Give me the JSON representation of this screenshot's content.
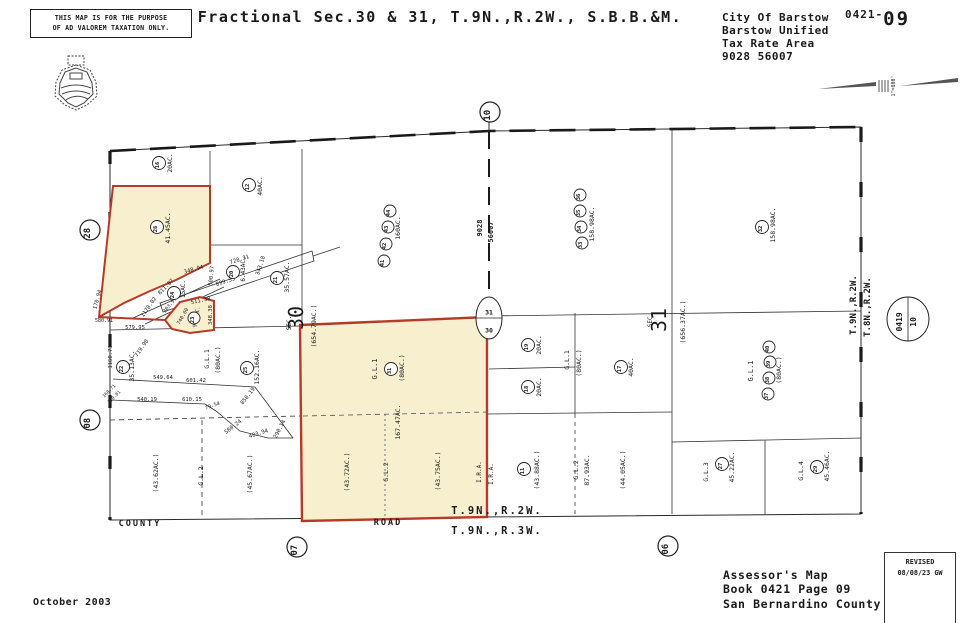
{
  "header": {
    "disclaimer_line1": "THIS MAP IS FOR THE PURPOSE",
    "disclaimer_line2": "OF AD VALOREM TAXATION ONLY.",
    "title": "Fractional Sec.30 & 31, T.9N.,R.2W., S.B.B.&M.",
    "agency_lines": [
      "City Of Barstow",
      "Barstow Unified",
      "Tax Rate Area",
      "9028 56007"
    ],
    "page_ref_prefix": "0421-",
    "page_ref_number": "09",
    "scale_label": "1\"=800'"
  },
  "footer": {
    "date": "October 2003",
    "assessor_lines": [
      "Assessor's Map",
      "Book 0421 Page 09",
      "San Bernardino County"
    ],
    "revised_title": "REVISED",
    "revised_note": "08/08/23 GW"
  },
  "colors": {
    "parcel_fill": "#f7efce",
    "parcel_stroke": "#b63a28",
    "line": "#2a2a2a"
  },
  "map": {
    "texts": [
      {
        "t": "20AC.",
        "x": 172,
        "y": 163,
        "r": -90,
        "s": 6.5
      },
      {
        "t": "40AC.",
        "x": 262,
        "y": 186,
        "r": -90,
        "s": 6.5
      },
      {
        "t": "41.45AC.",
        "x": 170,
        "y": 228,
        "r": -90,
        "s": 6.5
      },
      {
        "t": "15AC.",
        "x": 185,
        "y": 289,
        "r": -90,
        "s": 6
      },
      {
        "t": "6.43AC.",
        "x": 245,
        "y": 269,
        "r": -90,
        "s": 6
      },
      {
        "t": "35.57AC.",
        "x": 289,
        "y": 277,
        "r": -90,
        "s": 6.5
      },
      {
        "t": "160AC.",
        "x": 400,
        "y": 228,
        "r": -90,
        "s": 6.5
      },
      {
        "t": "9028",
        "x": 482,
        "y": 228,
        "r": -90,
        "s": 7,
        "b": true
      },
      {
        "t": "56007",
        "x": 493,
        "y": 232,
        "r": -90,
        "s": 7,
        "b": true
      },
      {
        "t": "158.98AC.",
        "x": 594,
        "y": 224,
        "r": -90,
        "s": 6.5
      },
      {
        "t": "158.98AC.",
        "x": 775,
        "y": 225,
        "r": -90,
        "s": 6.5
      },
      {
        "t": "SEC.",
        "x": 291,
        "y": 323,
        "r": -90,
        "s": 6
      },
      {
        "t": "30",
        "x": 303,
        "y": 318,
        "r": -90,
        "s": 20
      },
      {
        "t": "(654.79AC.)",
        "x": 316,
        "y": 326,
        "r": -90,
        "s": 6.5
      },
      {
        "t": "SEC.",
        "x": 652,
        "y": 320,
        "r": -90,
        "s": 6
      },
      {
        "t": "31",
        "x": 666,
        "y": 320,
        "r": -90,
        "s": 20
      },
      {
        "t": "(656.37AC.)",
        "x": 685,
        "y": 322,
        "r": -90,
        "s": 6.5
      },
      {
        "t": "T.9N.,R.2W.",
        "x": 856,
        "y": 305,
        "r": -90,
        "s": 9,
        "b": true
      },
      {
        "t": "T.8N.,R.2W.",
        "x": 870,
        "y": 307,
        "r": -90,
        "s": 9,
        "b": true
      },
      {
        "t": "728.31",
        "x": 240,
        "y": 261,
        "r": -18,
        "s": 5.5
      },
      {
        "t": "343.18",
        "x": 262,
        "y": 266,
        "r": -72,
        "s": 5.5
      },
      {
        "t": "899.35",
        "x": 226,
        "y": 283,
        "r": -18,
        "s": 5.5
      },
      {
        "t": "500.97",
        "x": 213,
        "y": 276,
        "r": -85,
        "s": 5.5
      },
      {
        "t": "348.94",
        "x": 194,
        "y": 271,
        "r": -15,
        "s": 5.5
      },
      {
        "t": "811.87",
        "x": 167,
        "y": 288,
        "r": -45,
        "s": 5.5
      },
      {
        "t": "1178.02",
        "x": 150,
        "y": 308,
        "r": -55,
        "s": 5.5
      },
      {
        "t": "303.57",
        "x": 171,
        "y": 306,
        "r": -50,
        "s": 5
      },
      {
        "t": "170.94",
        "x": 99,
        "y": 300,
        "r": -75,
        "s": 5.5
      },
      {
        "t": "580.91",
        "x": 104,
        "y": 322,
        "r": 0,
        "s": 5
      },
      {
        "t": "579.95",
        "x": 135,
        "y": 329,
        "r": 0,
        "s": 5.5
      },
      {
        "t": "511.38",
        "x": 201,
        "y": 302,
        "r": -12,
        "s": 5.5
      },
      {
        "t": "348.38",
        "x": 212,
        "y": 315,
        "r": -90,
        "s": 5.5
      },
      {
        "t": "740.60",
        "x": 184,
        "y": 317,
        "r": -60,
        "s": 5
      },
      {
        "t": "9.34AC.",
        "x": 198,
        "y": 317,
        "r": -80,
        "s": 5
      },
      {
        "t": "719.98",
        "x": 143,
        "y": 349,
        "r": -55,
        "s": 5.5
      },
      {
        "t": "1160.73",
        "x": 112,
        "y": 357,
        "r": -90,
        "s": 5.5
      },
      {
        "t": "35.13AC.",
        "x": 134,
        "y": 366,
        "r": -90,
        "s": 6.5
      },
      {
        "t": "549.64",
        "x": 163,
        "y": 379,
        "r": 0,
        "s": 5.5
      },
      {
        "t": "601.42",
        "x": 196,
        "y": 382,
        "r": 0,
        "s": 5.5
      },
      {
        "t": "850.19",
        "x": 249,
        "y": 397,
        "r": -52,
        "s": 5.5
      },
      {
        "t": "540.19",
        "x": 147,
        "y": 401,
        "r": 0,
        "s": 5.5
      },
      {
        "t": "610.15",
        "x": 192,
        "y": 401,
        "r": 0,
        "s": 5.5
      },
      {
        "t": "79.54",
        "x": 213,
        "y": 407,
        "r": -20,
        "s": 5
      },
      {
        "t": "160.71",
        "x": 110,
        "y": 392,
        "r": -45,
        "s": 4.5
      },
      {
        "t": "110.01",
        "x": 115,
        "y": 398,
        "r": -45,
        "s": 4.5
      },
      {
        "t": "580.24",
        "x": 234,
        "y": 428,
        "r": -38,
        "s": 5.5
      },
      {
        "t": "483.94",
        "x": 259,
        "y": 435,
        "r": -18,
        "s": 5.5
      },
      {
        "t": "290.14",
        "x": 281,
        "y": 430,
        "r": -62,
        "s": 5.5
      },
      {
        "t": "G.L.1",
        "x": 209,
        "y": 359,
        "r": -90,
        "s": 6.5
      },
      {
        "t": "(80AC.)",
        "x": 220,
        "y": 360,
        "r": -90,
        "s": 6.5
      },
      {
        "t": "152.16AC.",
        "x": 259,
        "y": 367,
        "r": -90,
        "s": 6.5
      },
      {
        "t": "G.L.1",
        "x": 377,
        "y": 369,
        "r": -90,
        "s": 7
      },
      {
        "t": "(80AC.)",
        "x": 404,
        "y": 368,
        "r": -90,
        "s": 6.5
      },
      {
        "t": "167.47AC.",
        "x": 400,
        "y": 422,
        "r": -90,
        "s": 6.5
      },
      {
        "t": "(43.72AC.)",
        "x": 349,
        "y": 472,
        "r": -90,
        "s": 6.5
      },
      {
        "t": "G.L.2",
        "x": 388,
        "y": 472,
        "r": -90,
        "s": 6.5
      },
      {
        "t": "(43.75AC.)",
        "x": 440,
        "y": 471,
        "r": -90,
        "s": 6.5
      },
      {
        "t": "I.R.A.",
        "x": 481,
        "y": 472,
        "r": -90,
        "s": 6
      },
      {
        "t": "I.R.A.",
        "x": 493,
        "y": 474,
        "r": -90,
        "s": 6
      },
      {
        "t": "20AC.",
        "x": 541,
        "y": 345,
        "r": -90,
        "s": 6.5
      },
      {
        "t": "20AC.",
        "x": 541,
        "y": 387,
        "r": -90,
        "s": 6.5
      },
      {
        "t": "G.L.1",
        "x": 569,
        "y": 360,
        "r": -90,
        "s": 6.5
      },
      {
        "t": "(80AC.)",
        "x": 581,
        "y": 363,
        "r": -90,
        "s": 6.5
      },
      {
        "t": "40AC.",
        "x": 633,
        "y": 367,
        "r": -90,
        "s": 6.5
      },
      {
        "t": "G.L.1",
        "x": 753,
        "y": 371,
        "r": -90,
        "s": 7
      },
      {
        "t": "(80AC.)",
        "x": 781,
        "y": 370,
        "r": -90,
        "s": 6.5
      },
      {
        "t": "(43.62AC.)",
        "x": 158,
        "y": 473,
        "r": -90,
        "s": 6.5
      },
      {
        "t": "G.L.2",
        "x": 203,
        "y": 476,
        "r": -90,
        "s": 6.5
      },
      {
        "t": "(45.67AC.)",
        "x": 252,
        "y": 474,
        "r": -90,
        "s": 6.5
      },
      {
        "t": "(43.88AC.)",
        "x": 539,
        "y": 470,
        "r": -90,
        "s": 6.5
      },
      {
        "t": "G.L.2",
        "x": 578,
        "y": 470,
        "r": -90,
        "s": 6.5
      },
      {
        "t": "87.93AC.",
        "x": 589,
        "y": 470,
        "r": -90,
        "s": 6.5
      },
      {
        "t": "(44.05AC.)",
        "x": 625,
        "y": 470,
        "r": -90,
        "s": 6.5
      },
      {
        "t": "G.L.3",
        "x": 708,
        "y": 472,
        "r": -90,
        "s": 6.5
      },
      {
        "t": "45.22AC.",
        "x": 734,
        "y": 467,
        "r": -90,
        "s": 6.5
      },
      {
        "t": "G.L.4",
        "x": 803,
        "y": 471,
        "r": -90,
        "s": 6.5
      },
      {
        "t": "45.46AC.",
        "x": 829,
        "y": 466,
        "r": -90,
        "s": 6.5
      },
      {
        "t": "COUNTY",
        "x": 140,
        "y": 526,
        "r": 0,
        "s": 8.5,
        "b": true,
        "ls": 2
      },
      {
        "t": "ROAD",
        "x": 388,
        "y": 525,
        "r": 0,
        "s": 8.5,
        "b": true,
        "ls": 2,
        "c": "#b63a28"
      },
      {
        "t": "T.9N.,R.2W.",
        "x": 497,
        "y": 514,
        "r": 0,
        "s": 10.5,
        "b": true,
        "ls": 2
      },
      {
        "t": "T.9N.,R.3W.",
        "x": 497,
        "y": 534,
        "r": 0,
        "s": 10.5,
        "b": true,
        "ls": 2
      }
    ],
    "circles": [
      {
        "n": "16",
        "x": 159,
        "y": 163,
        "rad": 6.5,
        "fs": 5.5
      },
      {
        "n": "12",
        "x": 249,
        "y": 185,
        "rad": 6.5,
        "fs": 5.5
      },
      {
        "n": "26",
        "x": 157,
        "y": 227,
        "rad": 6.5,
        "fs": 5.5
      },
      {
        "n": "24",
        "x": 174,
        "y": 293,
        "rad": 6.5,
        "fs": 5.5
      },
      {
        "n": "20",
        "x": 233,
        "y": 272,
        "rad": 6.5,
        "fs": 5.5
      },
      {
        "n": "21",
        "x": 277,
        "y": 278,
        "rad": 6.5,
        "fs": 5.5
      },
      {
        "n": "23",
        "x": 194,
        "y": 318,
        "rad": 6,
        "fs": 5.5
      },
      {
        "n": "22",
        "x": 123,
        "y": 367,
        "rad": 6.5,
        "fs": 5.5
      },
      {
        "n": "25",
        "x": 247,
        "y": 368,
        "rad": 6.5,
        "fs": 5.5
      },
      {
        "n": "41",
        "x": 384,
        "y": 261,
        "rad": 6,
        "fs": 5.5
      },
      {
        "n": "42",
        "x": 386,
        "y": 244,
        "rad": 6,
        "fs": 5.5
      },
      {
        "n": "43",
        "x": 388,
        "y": 227,
        "rad": 6,
        "fs": 5.5
      },
      {
        "n": "44",
        "x": 390,
        "y": 211,
        "rad": 6,
        "fs": 5.5
      },
      {
        "n": "33",
        "x": 582,
        "y": 243,
        "rad": 6,
        "fs": 5.5
      },
      {
        "n": "34",
        "x": 581,
        "y": 227,
        "rad": 6,
        "fs": 5.5
      },
      {
        "n": "35",
        "x": 580,
        "y": 211,
        "rad": 6,
        "fs": 5.5
      },
      {
        "n": "36",
        "x": 580,
        "y": 195,
        "rad": 6,
        "fs": 5.5
      },
      {
        "n": "32",
        "x": 762,
        "y": 227,
        "rad": 6.5,
        "fs": 5.5
      },
      {
        "n": "19",
        "x": 528,
        "y": 345,
        "rad": 6.5,
        "fs": 5.5
      },
      {
        "n": "18",
        "x": 528,
        "y": 387,
        "rad": 6.5,
        "fs": 5.5
      },
      {
        "n": "17",
        "x": 621,
        "y": 367,
        "rad": 6.5,
        "fs": 5.5
      },
      {
        "n": "31",
        "x": 391,
        "y": 369,
        "rad": 6.5,
        "fs": 5.5
      },
      {
        "n": "37",
        "x": 768,
        "y": 394,
        "rad": 6,
        "fs": 5.5
      },
      {
        "n": "38",
        "x": 769,
        "y": 378,
        "rad": 6,
        "fs": 5.5
      },
      {
        "n": "39",
        "x": 770,
        "y": 362,
        "rad": 6,
        "fs": 5.5
      },
      {
        "n": "40",
        "x": 769,
        "y": 347,
        "rad": 6,
        "fs": 5.5
      },
      {
        "n": "11",
        "x": 524,
        "y": 469,
        "rad": 6.5,
        "fs": 5.5
      },
      {
        "n": "27",
        "x": 722,
        "y": 464,
        "rad": 6.5,
        "fs": 5.5
      },
      {
        "n": "29",
        "x": 817,
        "y": 467,
        "rad": 6.5,
        "fs": 5.5
      },
      {
        "n": "10",
        "x": 490,
        "y": 112,
        "rad": 10,
        "fs": 9
      },
      {
        "n": "28",
        "x": 90,
        "y": 230,
        "rad": 10,
        "fs": 9
      },
      {
        "n": "08",
        "x": 90,
        "y": 420,
        "rad": 10,
        "fs": 9
      },
      {
        "n": "07",
        "x": 297,
        "y": 547,
        "rad": 10,
        "fs": 9
      },
      {
        "n": "06",
        "x": 668,
        "y": 546,
        "rad": 10,
        "fs": 9
      }
    ],
    "markers": [
      {
        "x": 489,
        "y": 318,
        "rx": 13,
        "ry": 21,
        "line": "h",
        "texts": [
          {
            "t": "31",
            "dx": 0,
            "dy": -6,
            "r": 0,
            "s": 6.5
          },
          {
            "t": "30",
            "dx": 0,
            "dy": 12,
            "r": 0,
            "s": 6.5
          }
        ]
      },
      {
        "x": 908,
        "y": 319,
        "rx": 21,
        "ry": 22,
        "line": "v",
        "texts": [
          {
            "t": "0419",
            "dx": -6,
            "dy": 0,
            "r": -90,
            "s": 8
          },
          {
            "t": "10",
            "dx": 8,
            "dy": 0,
            "r": -90,
            "s": 8
          }
        ]
      }
    ]
  }
}
